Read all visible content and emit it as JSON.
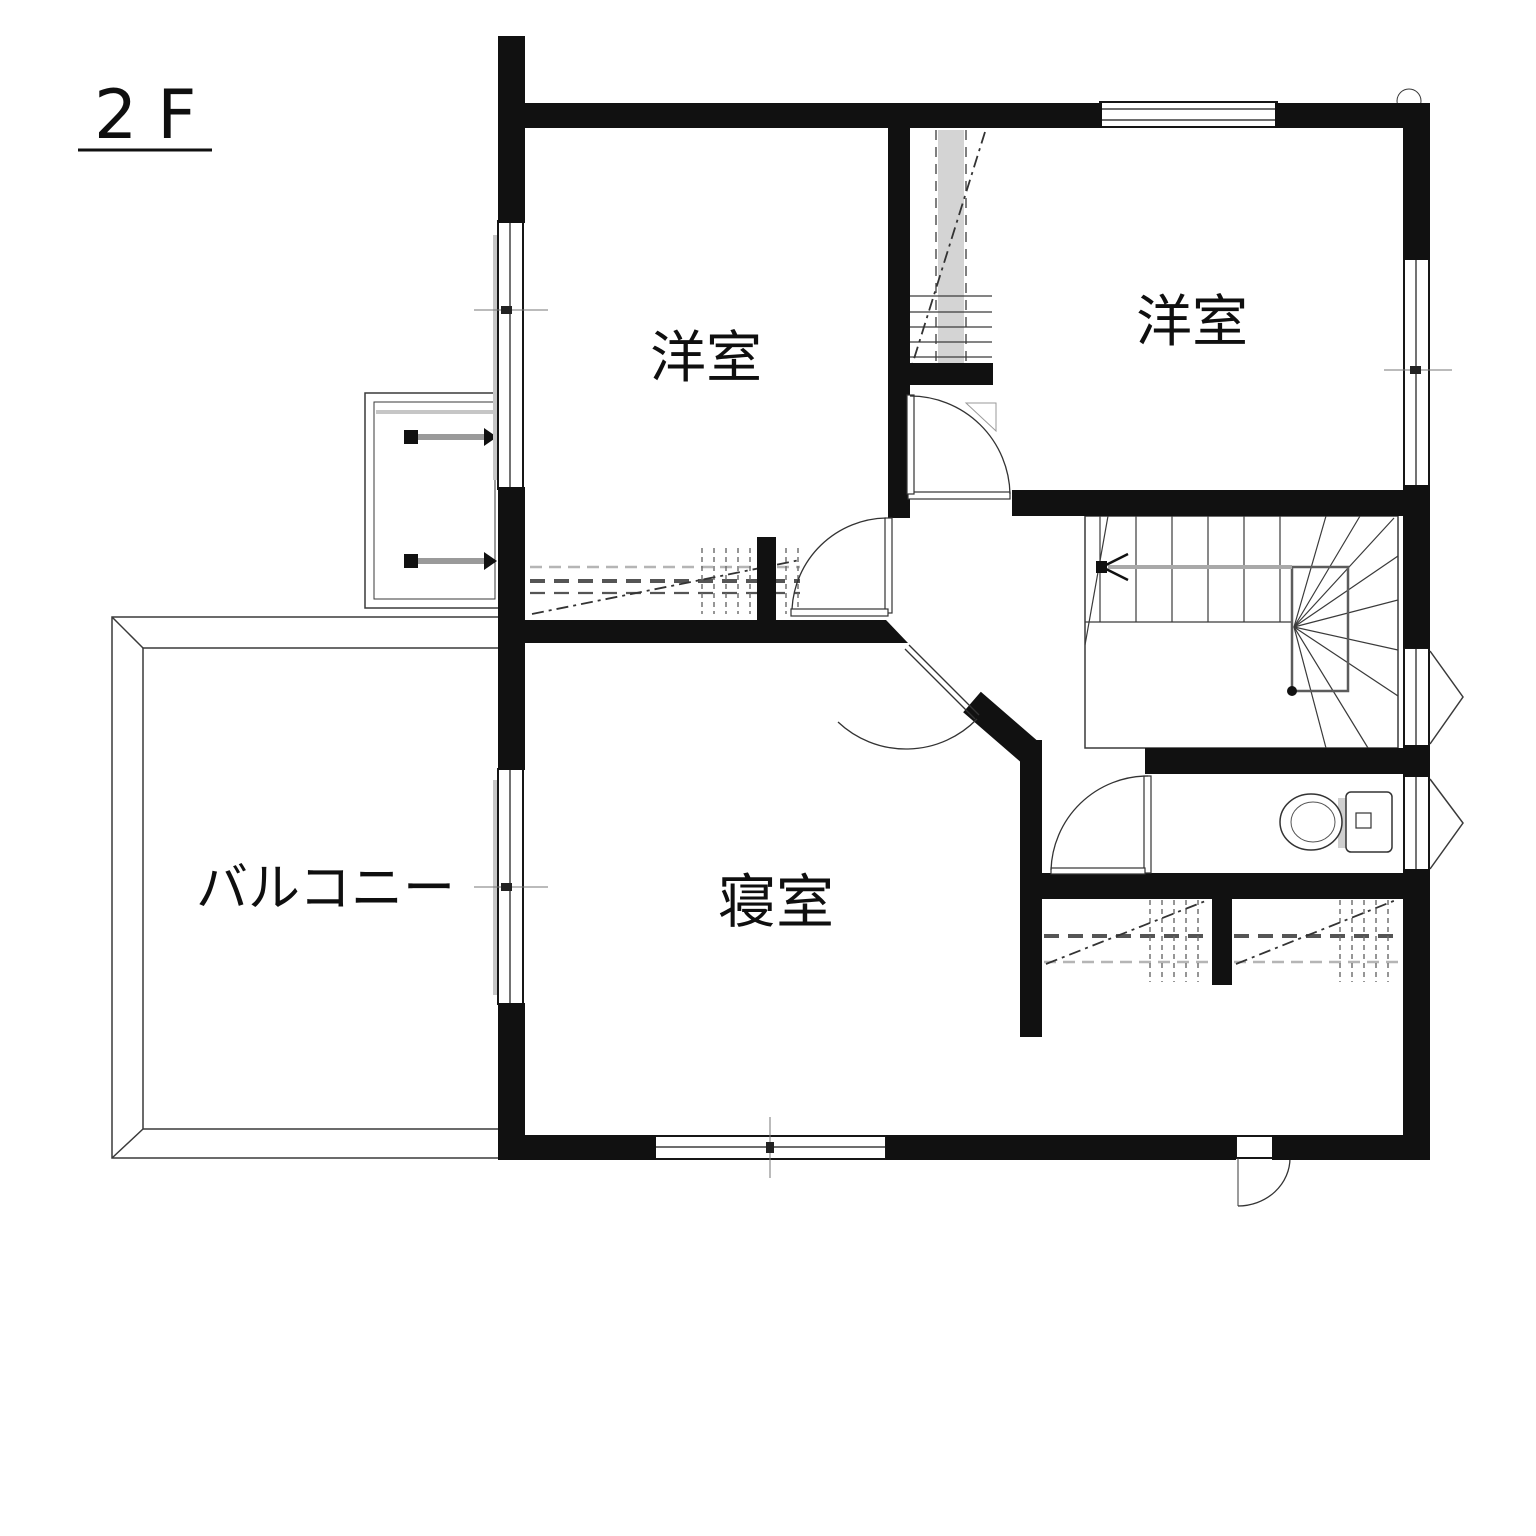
{
  "floor": {
    "label": "2F"
  },
  "rooms": {
    "western1": {
      "label": "洋室"
    },
    "western2": {
      "label": "洋室"
    },
    "bedroom": {
      "label": "寝室"
    },
    "balcony": {
      "label": "バルコニー"
    }
  },
  "colors": {
    "wall": "#111111",
    "line": "#3a3a3a",
    "hatch_gray": "#b5b5b5",
    "background": "#ffffff"
  }
}
